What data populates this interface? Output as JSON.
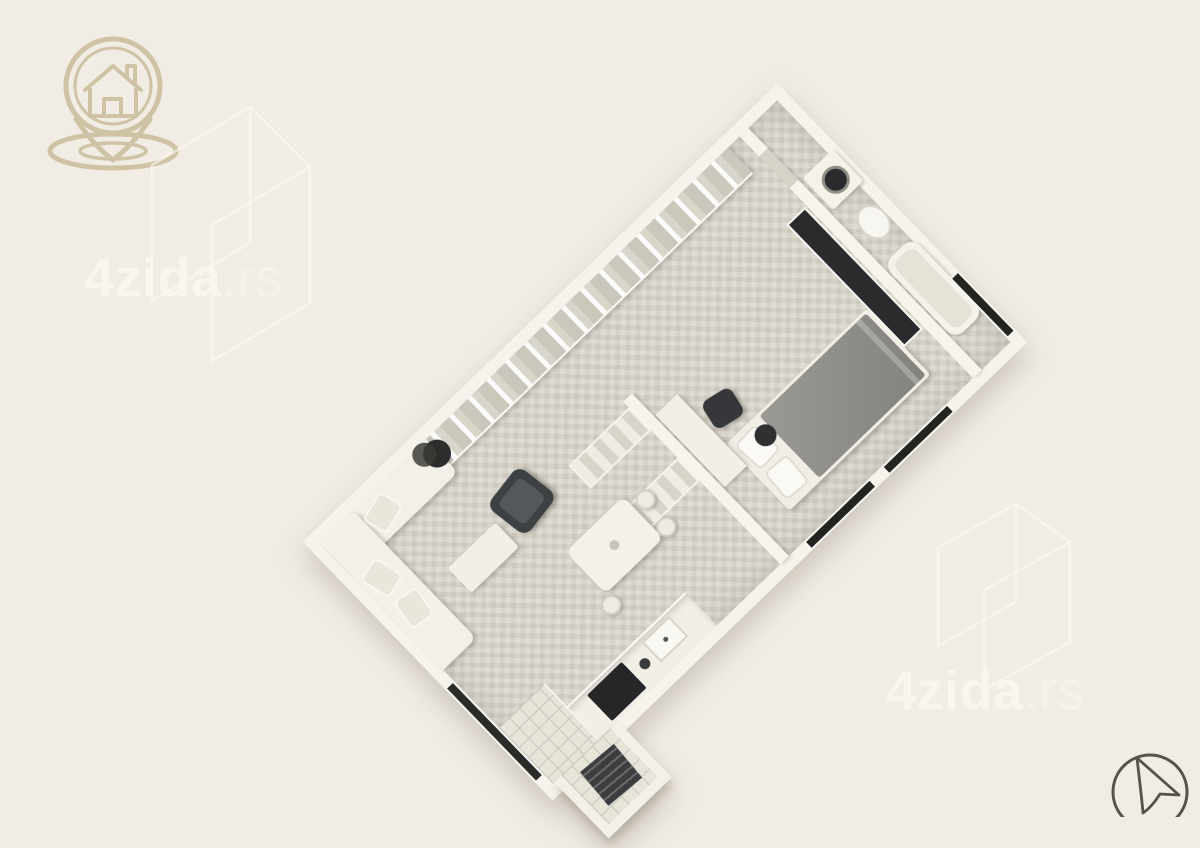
{
  "page": {
    "width": 1200,
    "height": 817,
    "background_color": "#f1ece4"
  },
  "watermarks": {
    "top_left": {
      "main": "4zida",
      "suffix": ".rs"
    },
    "bottom_right": {
      "main": "4zida",
      "suffix": ".rs"
    },
    "text_color": "#fbf7f0",
    "walls_logo_color": "#fdfaf3",
    "pin_logo_color": "#c6b995"
  },
  "floorplan": {
    "type": "3d-isometric-apartment-render",
    "rotation_deg": -44,
    "floor_color": "#d6d2c8",
    "wall_color": "#f6f3ec",
    "dark_accent": "#2a2b2d",
    "bed_blanket_color": "#8e8d88",
    "rooms": [
      "living-room",
      "dining-area",
      "kitchen",
      "hallway-closet",
      "bedroom",
      "bathroom",
      "entry-balcony"
    ],
    "furniture": [
      "l-shaped-sofa",
      "throw-pillows",
      "coffee-table",
      "armchair",
      "potted-plant",
      "wardrobe-wall",
      "dining-table",
      "dining-chairs",
      "kitchen-counter",
      "cooktop",
      "kitchen-sink",
      "double-bed",
      "bed-pillows",
      "desk",
      "office-chair",
      "stool",
      "tv-wardrobe-panel",
      "washing-machine",
      "toilet",
      "bathtub",
      "drying-rack",
      "windows"
    ]
  },
  "cursor_control": {
    "icon": "cursor-arrow-icon",
    "stroke_color": "#57524b"
  }
}
